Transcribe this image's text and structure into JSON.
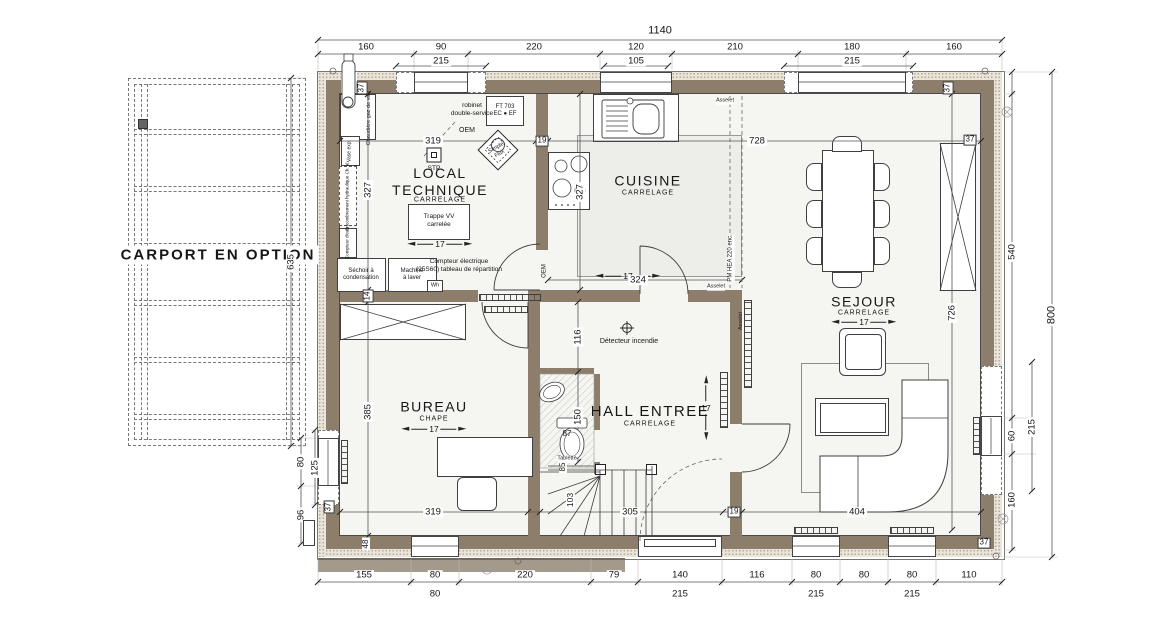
{
  "labels": {
    "carport": "CARPORT EN OPTION",
    "local_name": "LOCAL\nTECHNIQUE",
    "local_finish": "CARRELAGE",
    "cuisine_name": "CUISINE",
    "cuisine_finish": "CARRELAGE",
    "sejour_name": "SEJOUR",
    "sejour_finish": "CARRELAGE",
    "bureau_name": "BUREAU",
    "bureau_finish": "CHAPE",
    "hall_name": "HALL ENTREE",
    "hall_finish": "CARRELAGE",
    "level": "17"
  },
  "equipment": {
    "chaudiere": "Chaudière gaz de ville",
    "vase": "Vase exp.",
    "encombrement": "Encombrement hydraulique Ch. al.",
    "compteur_eau": "Compteur d'eau",
    "robinet": "robinet\ndouble-service",
    "ft703": "FT 703\nEC ● EF",
    "oem": "OEM",
    "stp": "STP",
    "simple_flux": "Simple\nFlux",
    "trappe": "Trappe VV\ncarrelée",
    "sechoir": "Séchoir à\ncondensation",
    "machine": "Machine\nà laver",
    "compteur_elec": "Compteur électrique\n(25S60) tableau de répartition",
    "wh": "Wh",
    "detecteur": "Détecteur incendie",
    "tablette": "Tablette",
    "pm_hea": "PM HEA 220 enc.",
    "asselet": "Asselet"
  },
  "dims": {
    "total_width": "1140",
    "top1": [
      "160",
      "90",
      "220",
      "120",
      "210",
      "180",
      "160"
    ],
    "top2": [
      "215",
      "105",
      "215"
    ],
    "bot1": [
      "155",
      "80",
      "220",
      "79",
      "140",
      "116",
      "80",
      "80",
      "80",
      "110"
    ],
    "bot2": [
      "80",
      "215",
      "215",
      "215"
    ],
    "right_540": "540",
    "right_60": "60",
    "right_160": "160",
    "right_215": "215",
    "right_800": "800",
    "right_726": "726",
    "left_635": "635",
    "left_80": "80",
    "left_125": "125",
    "left_96": "96",
    "left_48": "48",
    "wall_37": "37",
    "wall_19": "19",
    "wall_14": "14",
    "in_319": "319",
    "in_728": "728",
    "in_327": "327",
    "in_385": "385",
    "in_324": "324",
    "in_116": "116",
    "in_150": "150",
    "in_87": "87",
    "in_103": "103",
    "in_305": "305",
    "in_85": "85",
    "in_404": "404"
  },
  "colors": {
    "wall": "#8d7e6b",
    "insulation": "#ebe5d9",
    "floor": "#f5f5f2",
    "terrace": "#a39a8c"
  }
}
